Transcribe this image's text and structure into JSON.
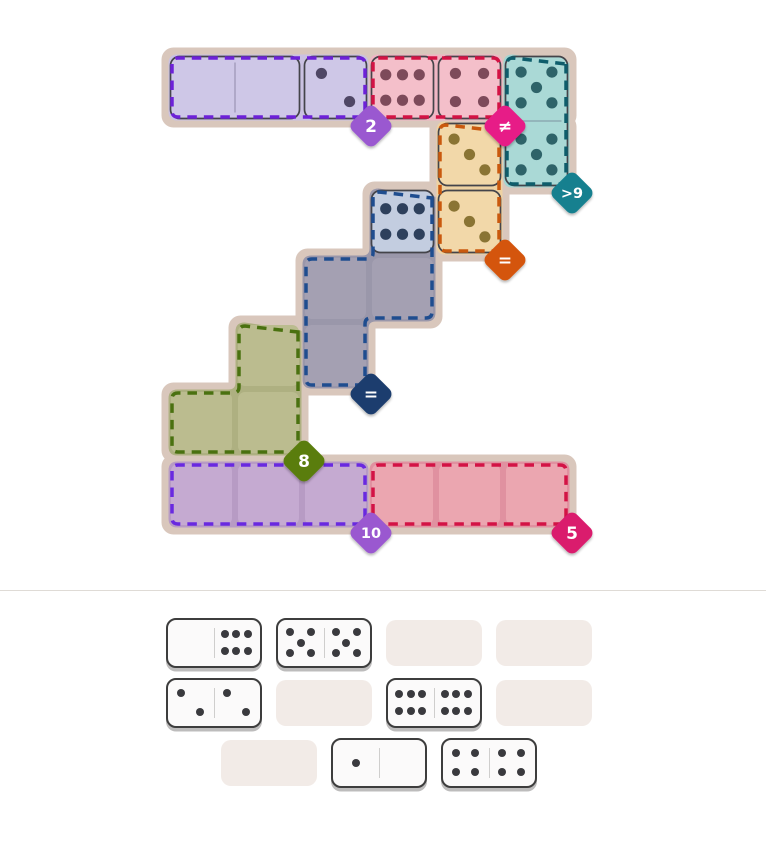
{
  "page": {
    "background": "#ffffff",
    "divider_color": "#dfdbd6"
  },
  "board": {
    "plate_color": "#d9c7bc",
    "tile_outline": "#44444a",
    "grid": {
      "origin_x": 168,
      "origin_y": 54,
      "cell": 67,
      "bottom_row_y": 461
    },
    "regions": [
      {
        "name": "purple-top",
        "constraint": "2",
        "cells": [
          [
            0,
            0
          ],
          [
            1,
            0
          ],
          [
            2,
            0
          ]
        ],
        "badge_cell": [
          2,
          0
        ],
        "colors": {
          "silhouette": "#cac1e2",
          "tile": "#cec7e7",
          "dash": "#6d21d8",
          "pip": "#4f4765",
          "badge": "#9a58d0"
        }
      },
      {
        "name": "pink-top",
        "constraint": "≠",
        "cells": [
          [
            3,
            0
          ],
          [
            4,
            0
          ]
        ],
        "badge_cell": [
          4,
          0
        ],
        "colors": {
          "silhouette": "#f0b6c4",
          "tile": "#f4bfca",
          "dash": "#d31345",
          "pip": "#7d4a5a",
          "badge": "#e71f87"
        }
      },
      {
        "name": "teal",
        "constraint": ">9",
        "cells": [
          [
            5,
            0
          ],
          [
            5,
            1
          ]
        ],
        "badge_cell": [
          5,
          1
        ],
        "colors": {
          "silhouette": "#a2d5d2",
          "tile": "#aad9d6",
          "dash": "#0e5d6b",
          "pip": "#2e6369",
          "badge": "#18808f"
        }
      },
      {
        "name": "orange",
        "constraint": "=",
        "cells": [
          [
            4,
            1
          ],
          [
            4,
            2
          ]
        ],
        "badge_cell": [
          4,
          2
        ],
        "colors": {
          "silhouette": "#eed2a2",
          "tile": "#f2d8a9",
          "dash": "#c9590e",
          "pip": "#8a7434",
          "badge": "#d4540a"
        }
      },
      {
        "name": "navy",
        "constraint": "=",
        "cells": [
          [
            3,
            2
          ],
          [
            2,
            3
          ],
          [
            3,
            3
          ],
          [
            2,
            4
          ]
        ],
        "badge_cell": [
          2,
          4
        ],
        "colors": {
          "silhouette": "#9a97aa",
          "cell": "#a4a0b2",
          "tile": "#c3cde0",
          "dash": "#1f4d8f",
          "pip": "#2e405c",
          "badge": "#1c3e6e"
        }
      },
      {
        "name": "olive",
        "constraint": "8",
        "cells": [
          [
            1,
            4
          ],
          [
            0,
            5
          ],
          [
            1,
            5
          ]
        ],
        "badge_cell": [
          1,
          5
        ],
        "colors": {
          "silhouette": "#aeb081",
          "cell": "#bbbc8f",
          "dash": "#4a7110",
          "pip": "#5a5a30",
          "badge": "#5a7d0b"
        }
      },
      {
        "name": "purple-bottom",
        "constraint": "10",
        "cells": [
          [
            0,
            6
          ],
          [
            1,
            6
          ],
          [
            2,
            6
          ]
        ],
        "badge_cell": [
          2,
          6
        ],
        "colors": {
          "silhouette": "#b79bc4",
          "cell": "#c5aad1",
          "dash": "#6929e0",
          "pip": "#4f4765",
          "badge": "#9a58d0"
        }
      },
      {
        "name": "red-bottom",
        "constraint": "5",
        "cells": [
          [
            3,
            6
          ],
          [
            4,
            6
          ],
          [
            5,
            6
          ]
        ],
        "badge_cell": [
          5,
          6
        ],
        "colors": {
          "silhouette": "#e091a0",
          "cell": "#eba6b0",
          "dash": "#d31345",
          "pip": "#7d4a5a",
          "badge": "#da1a6d"
        }
      }
    ],
    "placed_dominoes": [
      {
        "cells": [
          [
            0,
            0
          ],
          [
            1,
            0
          ]
        ],
        "pips": [
          0,
          0
        ],
        "joined": true
      },
      {
        "cells": [
          [
            2,
            0
          ],
          [
            3,
            0
          ]
        ],
        "pips": [
          2,
          6
        ],
        "joined": false
      },
      {
        "cells": [
          [
            4,
            0
          ],
          [
            4,
            1
          ]
        ],
        "pips": [
          4,
          3
        ],
        "joined": false
      },
      {
        "cells": [
          [
            5,
            0
          ],
          [
            5,
            1
          ]
        ],
        "pips": [
          5,
          5
        ],
        "joined": true
      },
      {
        "cells": [
          [
            3,
            2
          ],
          [
            4,
            2
          ]
        ],
        "pips": [
          6,
          3
        ],
        "joined": false
      }
    ]
  },
  "tray": {
    "slot_color": "#f2ebe7",
    "domino_bg": "#fbfafa",
    "domino_border": "#3d3d3d",
    "pip_color": "#3a3a3e",
    "rows": [
      [
        {
          "domino": [
            0,
            6
          ]
        },
        {
          "domino": [
            5,
            5
          ]
        },
        {
          "empty": true
        },
        {
          "empty": true
        }
      ],
      [
        {
          "domino": [
            2,
            2
          ]
        },
        {
          "empty": true
        },
        {
          "domino": [
            6,
            6
          ]
        },
        {
          "empty": true
        }
      ],
      [
        {
          "empty": true
        },
        {
          "domino": [
            1,
            0
          ]
        },
        {
          "domino": [
            4,
            4
          ]
        }
      ]
    ],
    "layout": {
      "row_tops": [
        618,
        678,
        738
      ],
      "row_lefts": [
        [
          166,
          276,
          386,
          496
        ],
        [
          166,
          276,
          386,
          496
        ],
        [
          221,
          331,
          441
        ]
      ]
    }
  }
}
